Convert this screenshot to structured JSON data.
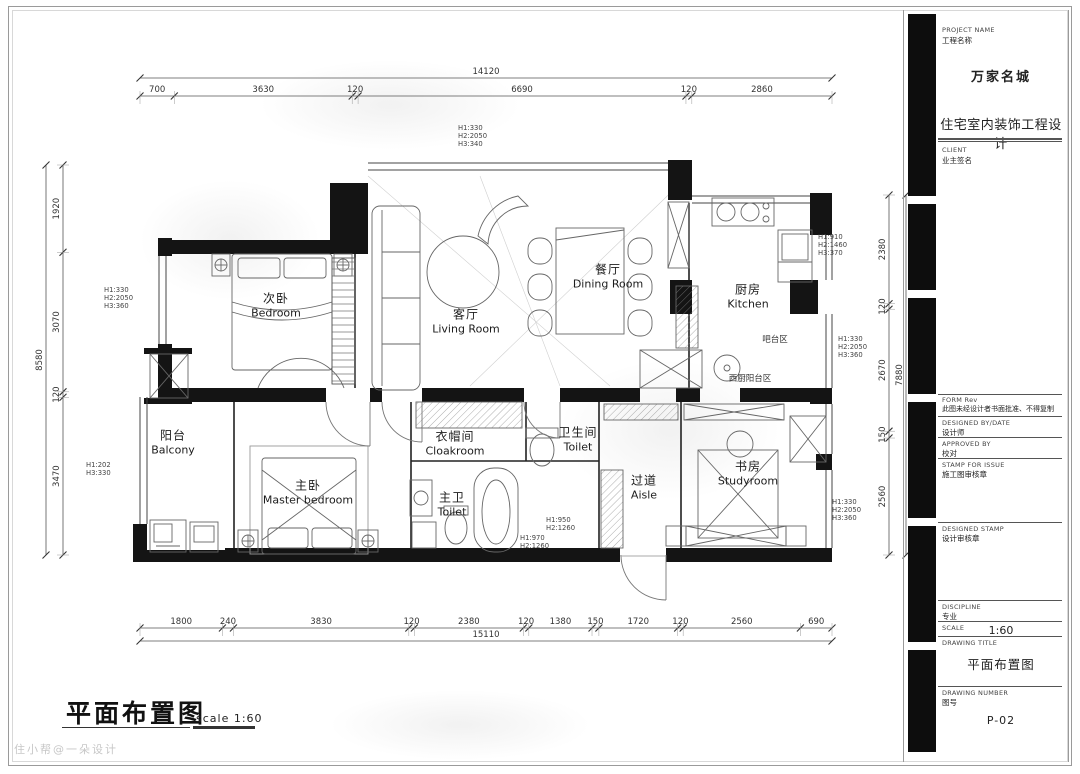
{
  "sheet": {
    "footer_title": "平面布置图",
    "footer_scale": "scale 1:60",
    "watermark": "住小帮@一朵设计"
  },
  "title_block": {
    "project_name_label": "PROJECT NAME",
    "project_name_label_zh": "工程名称",
    "project_name": "万家名城",
    "project_subtitle": "住宅室内装饰工程设计",
    "client_label": "CLIENT",
    "client_label_zh": "业主签名",
    "form_label": "FORM Rev",
    "form_note": "此图未经设计者书面批准、不得复制",
    "designed_by_label": "DESIGNED BY/DATE",
    "designed_by_zh": "设计师",
    "approved_by_label": "APPROVED BY",
    "approved_by_zh": "校对",
    "stamp_label": "STAMP FOR ISSUE",
    "stamp_zh": "施工图审核章",
    "designed_stamp_label": "DESIGNED STAMP",
    "designed_stamp_zh": "设计审核章",
    "discipline_label": "DISCIPLINE",
    "discipline_zh": "专业",
    "scale_label": "SCALE",
    "scale_value": "1:60",
    "drawing_title_label": "DRAWING TITLE",
    "drawing_title": "平面布置图",
    "drawing_number_label": "DRAWING NUMBER",
    "drawing_number_zh": "图号",
    "drawing_number": "P-02"
  },
  "plan": {
    "rooms": [
      {
        "id": "secondary-bedroom",
        "zh": "次卧",
        "en": "Bedroom"
      },
      {
        "id": "living-room",
        "zh": "客厅",
        "en": "Living Room"
      },
      {
        "id": "dining-room",
        "zh": "餐厅",
        "en": "Dining Room"
      },
      {
        "id": "kitchen",
        "zh": "厨房",
        "en": "Kitchen"
      },
      {
        "id": "balcony",
        "zh": "阳台",
        "en": "Balcony"
      },
      {
        "id": "master-bedroom",
        "zh": "主卧",
        "en": "Master bedroom"
      },
      {
        "id": "master-toilet",
        "zh": "主卫",
        "en": "Toilet"
      },
      {
        "id": "cloakroom",
        "zh": "衣帽间",
        "en": "Cloakroom"
      },
      {
        "id": "guest-toilet",
        "zh": "卫生间",
        "en": "Toilet"
      },
      {
        "id": "aisle",
        "zh": "过道",
        "en": "Aisle"
      },
      {
        "id": "study",
        "zh": "书房",
        "en": "Studyroom"
      }
    ],
    "zones": [
      {
        "id": "bar-area",
        "zh": "吧台区"
      },
      {
        "id": "west-kitchen-balcony",
        "zh": "西厨阳台区"
      }
    ],
    "height_notes": [
      {
        "id": "living-top",
        "lines": [
          "H1:330",
          "H2:2050",
          "H3:340"
        ]
      },
      {
        "id": "bedroom-left",
        "lines": [
          "H1:330",
          "H2:2050",
          "H3:360"
        ]
      },
      {
        "id": "kitchen-right",
        "lines": [
          "H1:910",
          "H2:1460",
          "H3:370"
        ]
      },
      {
        "id": "bar-right",
        "lines": [
          "H1:330",
          "H2:2050",
          "H3:360"
        ]
      },
      {
        "id": "study-right",
        "lines": [
          "H1:330",
          "H2:2050",
          "H3:360"
        ]
      },
      {
        "id": "balcony-left",
        "lines": [
          "H1:202",
          "H3:330"
        ]
      },
      {
        "id": "aisle-upper",
        "lines": [
          "H1:950",
          "H2:1260"
        ]
      },
      {
        "id": "aisle-lower",
        "lines": [
          "H1:970",
          "H2:1260"
        ]
      }
    ],
    "dimensions": {
      "top": {
        "overall": "14120",
        "segments": [
          "700",
          "3630",
          "120",
          "6690",
          "120",
          "2860"
        ]
      },
      "bottom": {
        "overall": "15110",
        "segments": [
          "1800",
          "240",
          "3830",
          "120",
          "2380",
          "120",
          "1380",
          "150",
          "1720",
          "120",
          "2560",
          "690"
        ]
      },
      "left": {
        "overall": "8580",
        "segments": [
          "1920",
          "3070",
          "120",
          "3470"
        ]
      },
      "right": {
        "overall": "7880",
        "segments": [
          "2380",
          "120",
          "2670",
          "150",
          "2560"
        ]
      }
    }
  }
}
